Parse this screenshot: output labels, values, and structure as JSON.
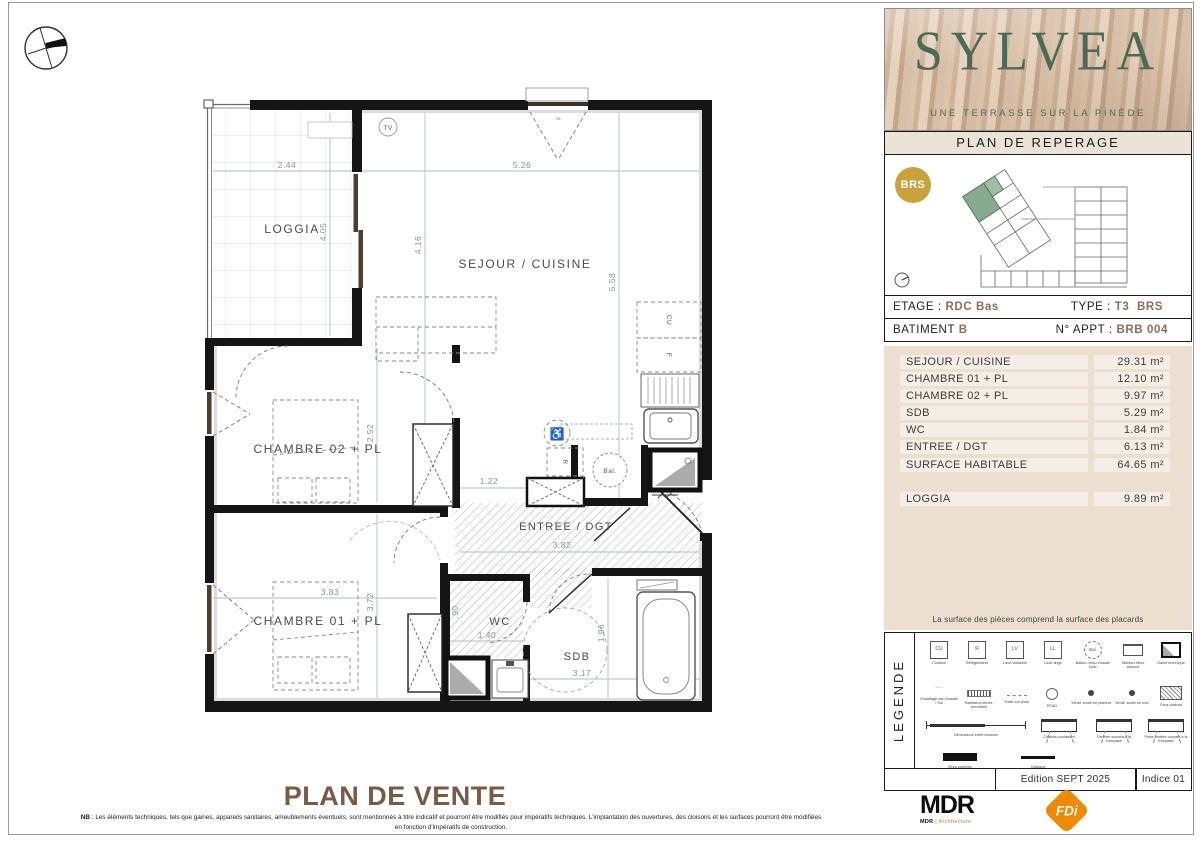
{
  "plan": {
    "title": "PLAN DE VENTE",
    "note_bold": "NB",
    "note_line1": " : Les éléments techniques, tels que gaines, appareils sanitaires, ameublements éventuels, sont mentionnés à titre indicatif et pourront être modifiés pour impératifs techniques. L'implantation des ouvertures, des cloisons et les surfaces pourront être modifiées",
    "note_line2": "en fonction d'impératifs de construction.",
    "rooms": {
      "loggia": "LOGGIA",
      "sejour": "SEJOUR / CUISINE",
      "chambre2": "CHAMBRE 02 + PL",
      "chambre1": "CHAMBRE 01 + PL",
      "entree": "ENTREE / DGT",
      "wc": "WC",
      "sdb": "SDB"
    },
    "dims": {
      "loggia_w": "2.44",
      "loggia_h": "4.05",
      "sejour_w": "5.26",
      "sejour_h_left": "4.16",
      "sejour_h_right": "5.58",
      "chambre2_h": "2.52",
      "entry_pl_w": "1.22",
      "chambre1_w": "3.83",
      "chambre1_h": "3.72",
      "entree_w": "3.82",
      "wc_w": "1.40",
      "wc_h": ".90",
      "sdb_w": "3.17",
      "sdb_h": "1.96"
    },
    "symbols": {
      "bal": "Bal.",
      "tv": "TV",
      "cu": "CU",
      "f": "F",
      "r": "R",
      "vb": "VB"
    }
  },
  "sidebar": {
    "brand": {
      "name": "SYLVEA",
      "tagline": "UNE TERRASSE SUR LA PINÈDE"
    },
    "reperage": {
      "title": "PLAN DE REPERAGE",
      "badge": "BRS"
    },
    "info": {
      "etage_label": "ETAGE : ",
      "etage_value": "RDC Bas",
      "type_label": "TYPE : ",
      "type_value": "T3  BRS",
      "batiment_label": "BATIMENT ",
      "batiment_value": "B",
      "appt_label": "N° APPT : ",
      "appt_value": "BRB 004"
    },
    "surfaces": {
      "rows": [
        {
          "label": "SEJOUR / CUISINE",
          "value": "29.31 m²"
        },
        {
          "label": "CHAMBRE 01 + PL",
          "value": "12.10 m²"
        },
        {
          "label": "CHAMBRE 02 + PL",
          "value": "9.97 m²"
        },
        {
          "label": "SDB",
          "value": "5.29 m²"
        },
        {
          "label": "WC",
          "value": "1.84 m²"
        },
        {
          "label": "ENTREE / DGT",
          "value": "6.13 m²"
        },
        {
          "label": "SURFACE HABITABLE",
          "value": "64.65 m²"
        }
      ],
      "loggia_row": {
        "label": "LOGGIA",
        "value": "9.89 m²"
      },
      "note": "La surface des pièces comprend la surface des placards"
    },
    "legend": {
      "title": "LEGENDE",
      "row1": [
        {
          "sym": "CU",
          "label": "Cuisson"
        },
        {
          "sym": "R",
          "label": "Réfrigérateur"
        },
        {
          "sym": "LV",
          "label": "Lave-vaisselle"
        },
        {
          "sym": "LL",
          "label": "Lave-linge"
        },
        {
          "sym": "Bal.",
          "label": "Ballon d'eau chaude indiv."
        },
        {
          "sym": "",
          "label": "Tableau élect. abonné"
        },
        {
          "sym": "",
          "label": "Gaine technique"
        }
      ],
      "row2": [
        {
          "sym": "",
          "label": "Chauffage eau chaude / Sol"
        },
        {
          "sym": "",
          "label": "Radiateur sèche-serviettes"
        },
        {
          "sym": "",
          "label": "Dalle sur plots"
        },
        {
          "sym": "PEAD",
          "label": "PEAD"
        },
        {
          "sym": "",
          "label": "Ventil. sortie en plafond"
        },
        {
          "sym": "",
          "label": "Ventil. sortie en mur"
        },
        {
          "sym": "",
          "label": "Faux plafond"
        }
      ],
      "row3": [
        {
          "label": "Dimensions entre cloisons"
        },
        {
          "label": "Châssis coulissant"
        },
        {
          "label": "Fenêtre ouvrant à la française"
        },
        {
          "label": "Porte-fenêtre ouvrant à la française"
        }
      ],
      "row4": [
        {
          "label": "Murs porteurs"
        },
        {
          "label": "Cloisons"
        }
      ]
    },
    "edition": {
      "edition": "Edition SEPT 2025",
      "indice": "Indice 01"
    },
    "logos": {
      "mdr_main": "MDR",
      "mdr_sub_bold": "MDR",
      "mdr_sub_rest": " | Architecture",
      "fdi": "FDi"
    }
  }
}
